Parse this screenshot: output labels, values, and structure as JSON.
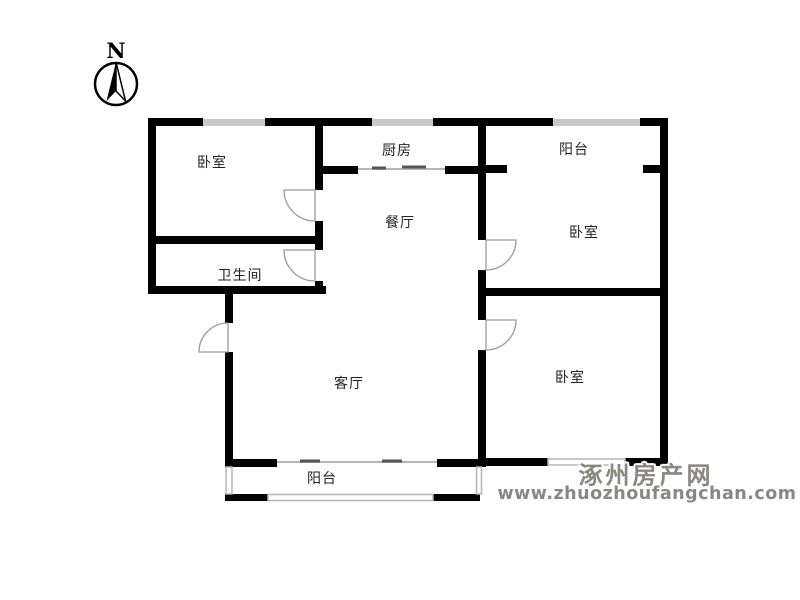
{
  "compass": {
    "label": "N"
  },
  "rooms": [
    {
      "id": "bedroom-top-left",
      "name": "卧室"
    },
    {
      "id": "kitchen",
      "name": "厨房"
    },
    {
      "id": "balcony-top",
      "name": "阳台"
    },
    {
      "id": "dining-room",
      "name": "餐厅"
    },
    {
      "id": "bedroom-right-middle",
      "name": "卧室"
    },
    {
      "id": "bathroom",
      "name": "卫生间"
    },
    {
      "id": "living-room",
      "name": "客厅"
    },
    {
      "id": "bedroom-right-bottom",
      "name": "卧室"
    },
    {
      "id": "balcony-bottom",
      "name": "阳台"
    }
  ],
  "watermark": {
    "site_name": "涿州房产网",
    "site_url": "www.zhuozhoufangchan.com"
  },
  "colors": {
    "wall": "#000000",
    "window_bar": "#c9c9c9",
    "window_line": "#b5b5b5",
    "door_arc": "#9a9a9a",
    "label_text": "#222222",
    "watermark": "#8a8782",
    "background": "#ffffff"
  }
}
